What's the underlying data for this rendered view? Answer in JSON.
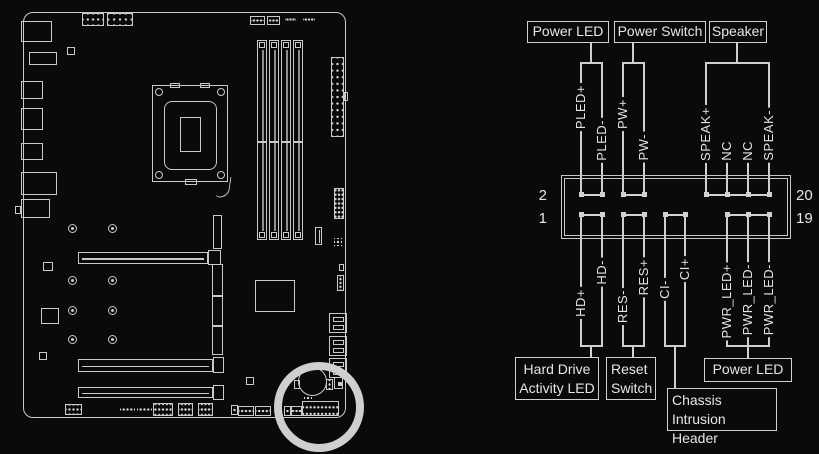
{
  "pinout": {
    "numbers": {
      "top_left": "2",
      "bottom_left": "1",
      "top_right": "20",
      "bottom_right": "19"
    },
    "top_boxes": [
      {
        "label": "Power LED"
      },
      {
        "label": "Power Switch"
      },
      {
        "label": "Speaker"
      }
    ],
    "top_pin_labels": [
      "PLED+",
      "PLED-",
      "PW+",
      "PW-",
      "SPEAK+",
      "NC",
      "NC",
      "SPEAK-"
    ],
    "bottom_pin_labels": [
      "HD+",
      "HD-",
      "RES-",
      "RES+",
      "CI-",
      "CI+",
      "PWR_LED+",
      "PWR_LED-",
      "PWR_LED-"
    ],
    "bottom_boxes": [
      {
        "lines": [
          "Hard Drive",
          "Activity LED"
        ]
      },
      {
        "lines": [
          "Reset",
          "Switch"
        ]
      },
      {
        "lines": [
          "Chassis Intrusion",
          "Header"
        ]
      },
      {
        "lines": [
          "Power LED"
        ]
      }
    ],
    "colors": {
      "background": "#0a0a0a",
      "line": "#cfcfcf",
      "text": "#e4e4e4",
      "highlight": "#cfcfcf"
    }
  }
}
